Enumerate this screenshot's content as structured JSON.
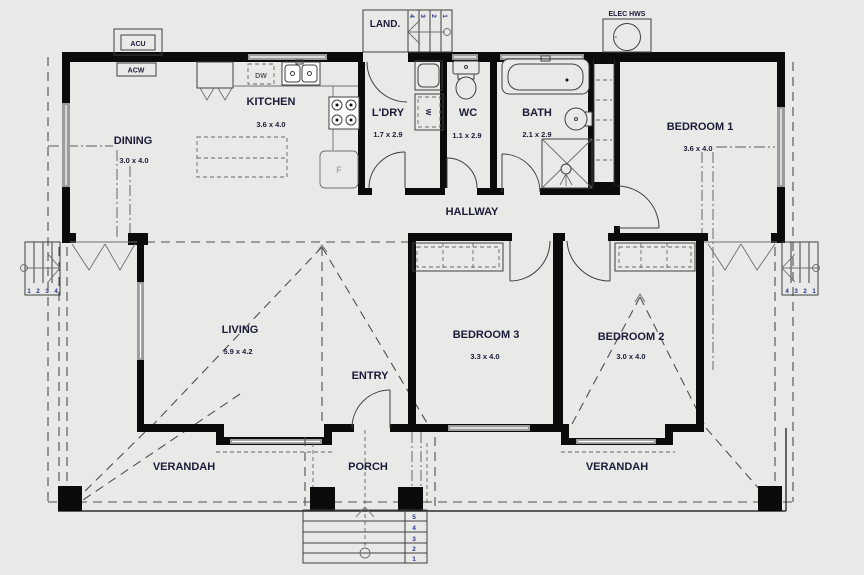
{
  "rooms": {
    "dining": {
      "name": "DINING",
      "size": "3.0 x 4.0"
    },
    "kitchen": {
      "name": "KITCHEN",
      "size": "3.6 x 4.0"
    },
    "laundry": {
      "name": "L'DRY",
      "size": "1.7 x 2.9"
    },
    "wc": {
      "name": "WC",
      "size": "1.1 x 2.9"
    },
    "bath": {
      "name": "BATH",
      "size": "2.1 x 2.9"
    },
    "bedroom1": {
      "name": "BEDROOM 1",
      "size": "3.6 x 4.0"
    },
    "hallway": {
      "name": "HALLWAY"
    },
    "living": {
      "name": "LIVING",
      "size": "5.9 x 4.2"
    },
    "entry": {
      "name": "ENTRY"
    },
    "bedroom3": {
      "name": "BEDROOM 3",
      "size": "3.3 x 4.0"
    },
    "bedroom2": {
      "name": "BEDROOM 2",
      "size": "3.0 x 4.0"
    },
    "verandah_left": {
      "name": "VERANDAH"
    },
    "verandah_right": {
      "name": "VERANDAH"
    },
    "porch": {
      "name": "PORCH"
    },
    "landing": {
      "name": "LAND."
    }
  },
  "equipment": {
    "acu": "ACU",
    "acw": "ACW",
    "hws": "ELEC HWS",
    "dishwasher": "DW",
    "washer": "W",
    "fridge": "F"
  },
  "steps": {
    "front": [
      "5",
      "4",
      "3",
      "2",
      "1"
    ],
    "left": [
      "1",
      "2",
      "3",
      "4"
    ],
    "right": [
      "4",
      "3",
      "2",
      "1"
    ],
    "rear": [
      "4",
      "3",
      "2",
      "1"
    ]
  },
  "colors": {
    "background": "#e9e9e7",
    "wall": "#0b0b0b",
    "label": "#1a1c38",
    "step_number": "#2b3990",
    "window": "#9c9c9c",
    "line": "#3f3f3f"
  }
}
